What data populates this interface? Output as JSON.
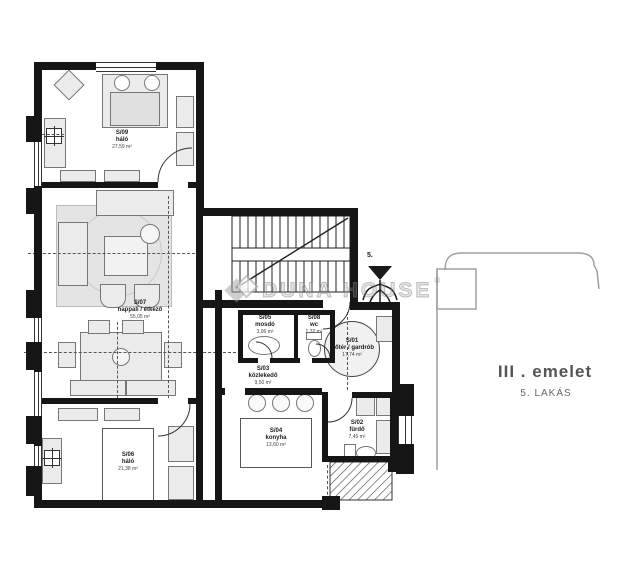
{
  "title": "Apartment floor plan",
  "side_panel": {
    "floor": "III . emelet",
    "unit": "5. LAKÁS"
  },
  "watermark": {
    "brand": "DUNA HOUSE",
    "registered": "®"
  },
  "stairs": {
    "number": "5."
  },
  "rooms": [
    {
      "id": "S/09",
      "name": "háló",
      "area": "27,59 m²"
    },
    {
      "id": "S/07",
      "name": "nappali / étkező",
      "area": "55,05 m²"
    },
    {
      "id": "S/05",
      "name": "mosdó",
      "area": "3,06 m²"
    },
    {
      "id": "S/08",
      "name": "wc",
      "area": "1,32 m²"
    },
    {
      "id": "S/01",
      "name": "előtér / gardrób",
      "area": "17,74 m²"
    },
    {
      "id": "S/03",
      "name": "közlekedő",
      "area": "9,50 m²"
    },
    {
      "id": "S/04",
      "name": "konyha",
      "area": "13,60 m²"
    },
    {
      "id": "S/02",
      "name": "fürdő",
      "area": "7,45 m²"
    },
    {
      "id": "S/06",
      "name": "háló",
      "area": "21,38 m²"
    }
  ],
  "colors": {
    "wall": "#161616",
    "furniture": "#ebebeb",
    "watermark_gray": "#9f9f9f",
    "outline_gray": "#a0a0a0"
  }
}
